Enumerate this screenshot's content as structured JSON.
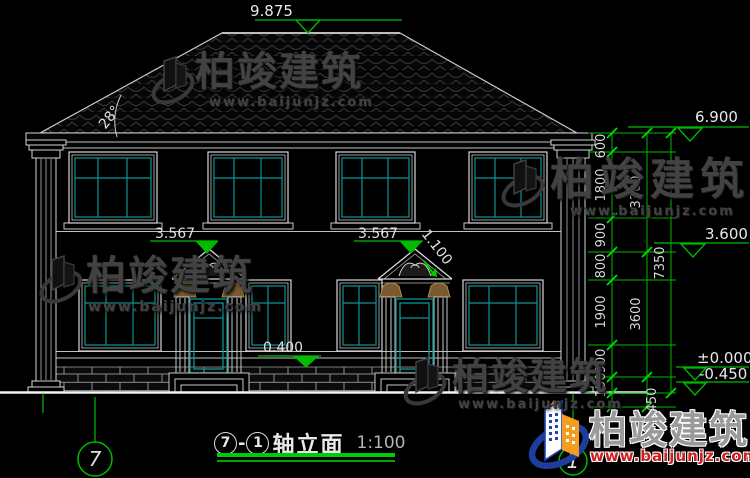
{
  "title": {
    "axis_left": "7",
    "separator": "-",
    "axis_right": "1",
    "name": "轴立面",
    "scale": "1:100"
  },
  "levels": {
    "ridge": "9.875",
    "eave": "6.900",
    "floor2": "3.600",
    "zero": "±0.000",
    "ground": "-0.450",
    "door1_top": "3.567",
    "door2_top": "3.567",
    "window_sill": "0.400",
    "pediment": "1.100",
    "roof_angle": "28°"
  },
  "dimensions": {
    "inner": [
      "600",
      "1800",
      "900",
      "800",
      "1900",
      "900",
      "150"
    ],
    "middle": [
      "3300",
      "3600",
      "450"
    ],
    "outer": "7350"
  },
  "axis_bubbles": {
    "left": "7",
    "right": "1"
  },
  "watermark": {
    "brand": "柏竣建筑",
    "url": "www.baijunjz.com"
  },
  "colors": {
    "dimension_green": "#00bb00",
    "glass_teal": "#0e9494",
    "drawing_white": "#d4d4d4",
    "capital_brown": "#7a5a2e",
    "logo_blue": "#1d43b5",
    "logo_orange": "#f59d1e",
    "logo_url_red": "#cf1f1f"
  }
}
